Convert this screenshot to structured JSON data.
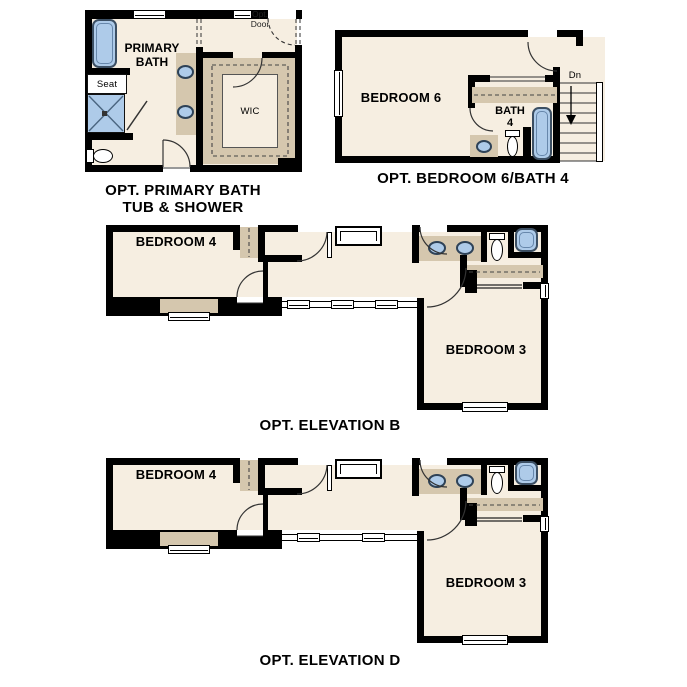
{
  "colors": {
    "floor": "#f6eee1",
    "tan": "#d5c7ae",
    "blue": "#aecbe9",
    "wall": "#000000"
  },
  "plans": {
    "primary_bath": {
      "caption_line1": "OPT. PRIMARY BATH",
      "caption_line2": "TUB & SHOWER",
      "room_primary_bath_line1": "PRIMARY",
      "room_primary_bath_line2": "BATH",
      "room_wic": "WIC",
      "label_seat": "Seat",
      "label_opt_door_line1": "Opt.",
      "label_opt_door_line2": "Door"
    },
    "bedroom6_bath4": {
      "caption": "OPT. BEDROOM 6/BATH 4",
      "room_bedroom6": "BEDROOM 6",
      "room_bath4_line1": "BATH",
      "room_bath4_line2": "4",
      "label_stairs_down": "Dn"
    },
    "elevation_b": {
      "caption": "OPT. ELEVATION B",
      "room_bedroom4": "BEDROOM 4",
      "room_bedroom3": "BEDROOM 3"
    },
    "elevation_d": {
      "caption": "OPT. ELEVATION D",
      "room_bedroom4": "BEDROOM 4",
      "room_bedroom3": "BEDROOM 3"
    }
  }
}
